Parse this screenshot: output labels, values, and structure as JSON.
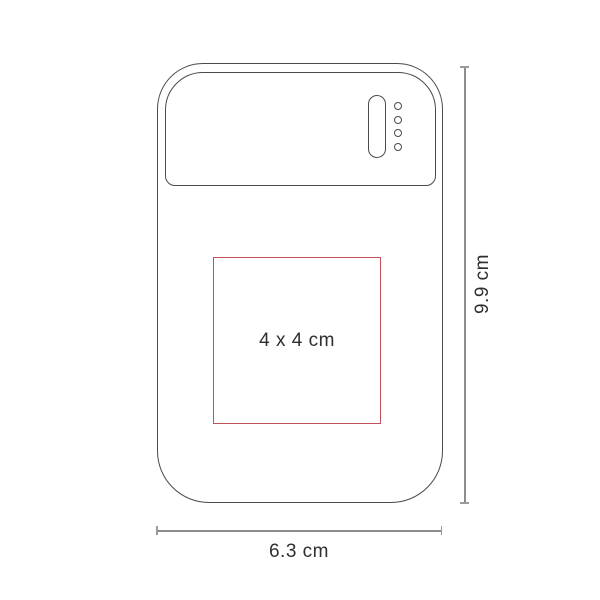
{
  "labels": {
    "print_area": "4 x 4 cm",
    "device_height": "9.9 cm",
    "device_width": "6.3 cm"
  },
  "icons": {
    "power_button": "pill-outline",
    "led_indicators": "four-circle-dots"
  },
  "colors": {
    "device_outline": "#4a4a4a",
    "dimension_line": "#8c8c8c",
    "print_area_border": "#c25058",
    "label_text": "#2f2f2f",
    "background": "#ffffff"
  }
}
